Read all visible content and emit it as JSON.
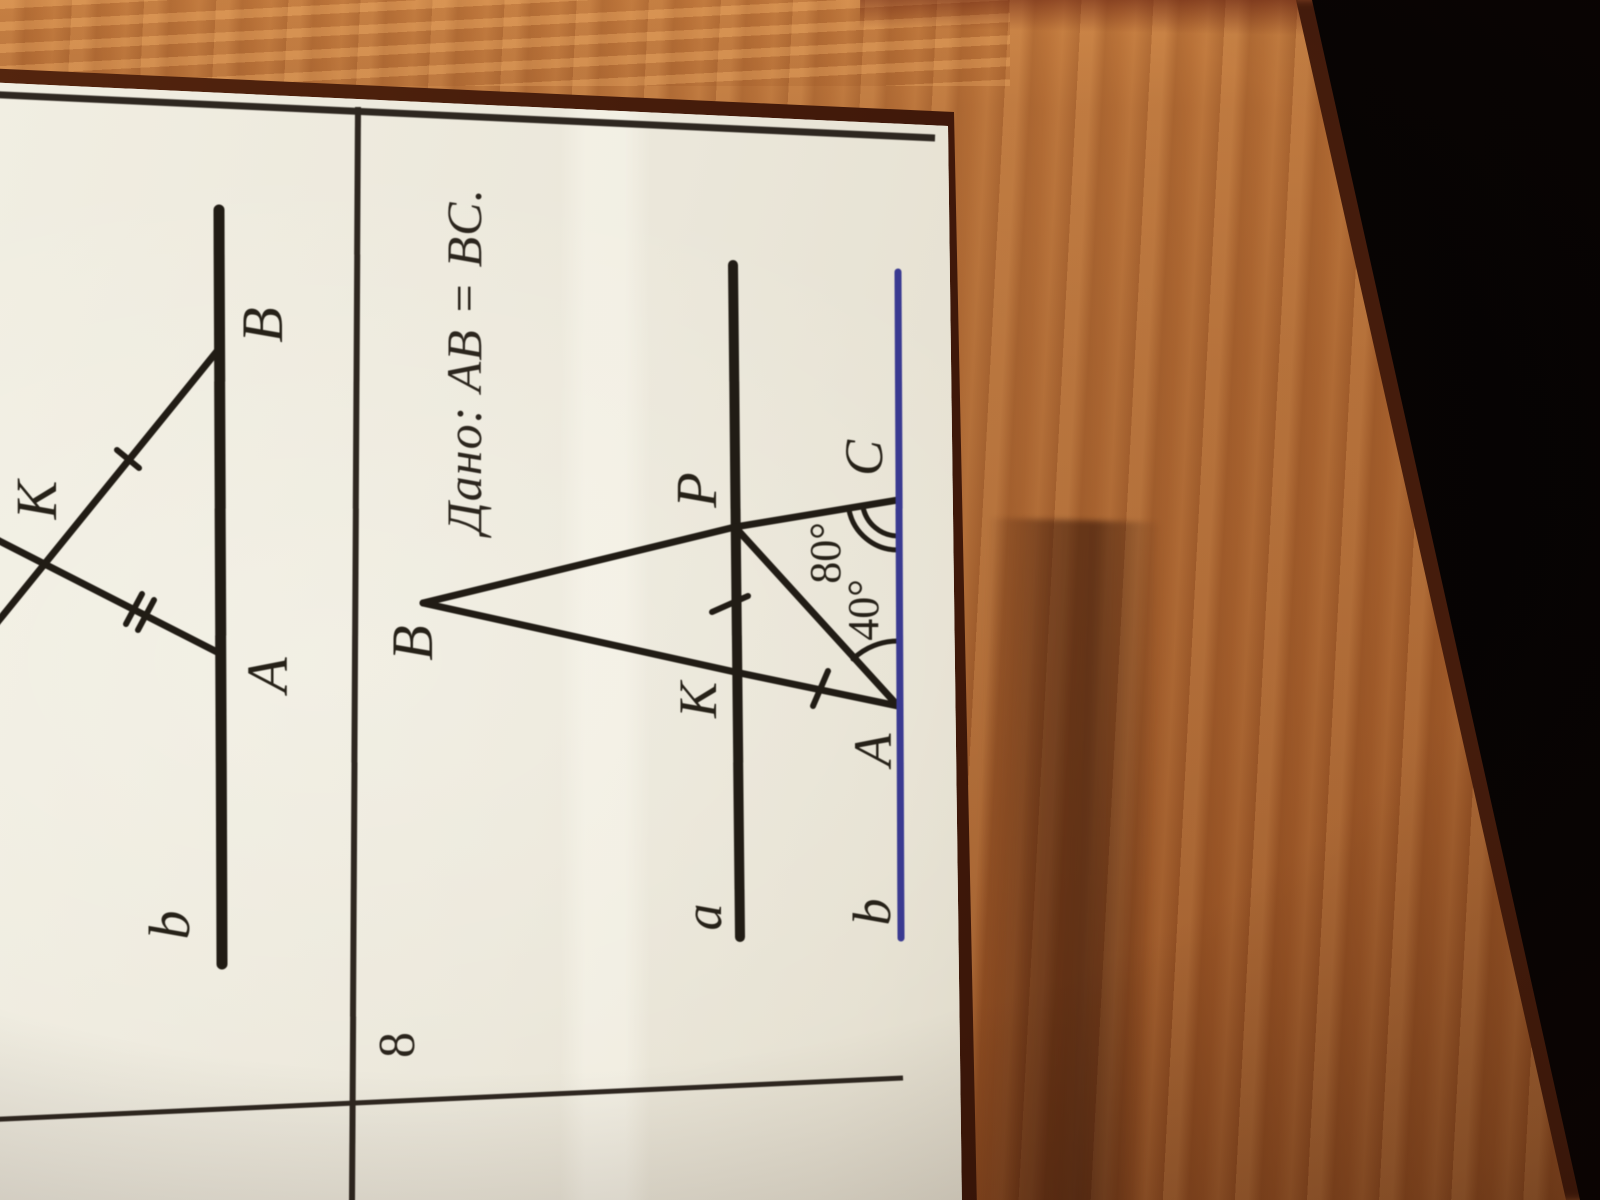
{
  "problem7": {
    "labels": {
      "line_b": "b",
      "point_A": "A",
      "point_B": "B",
      "point_K": "K"
    }
  },
  "problem8": {
    "number": "8",
    "given": "Дано: AB = BC.",
    "labels": {
      "point_B": "B",
      "point_P": "P",
      "point_K": "K",
      "point_A": "A",
      "point_C": "C",
      "line_a": "a",
      "line_b": "b"
    },
    "angles": {
      "angle_at_C": "80°",
      "angle_at_A": "40°"
    }
  },
  "colors": {
    "ink": "#211c15",
    "grid_line": "#2e2720",
    "blue_line": "#3a3a91",
    "paper": "#e8e4d6",
    "wood": "#a45f2c",
    "dark_corner": "#0a0504"
  }
}
